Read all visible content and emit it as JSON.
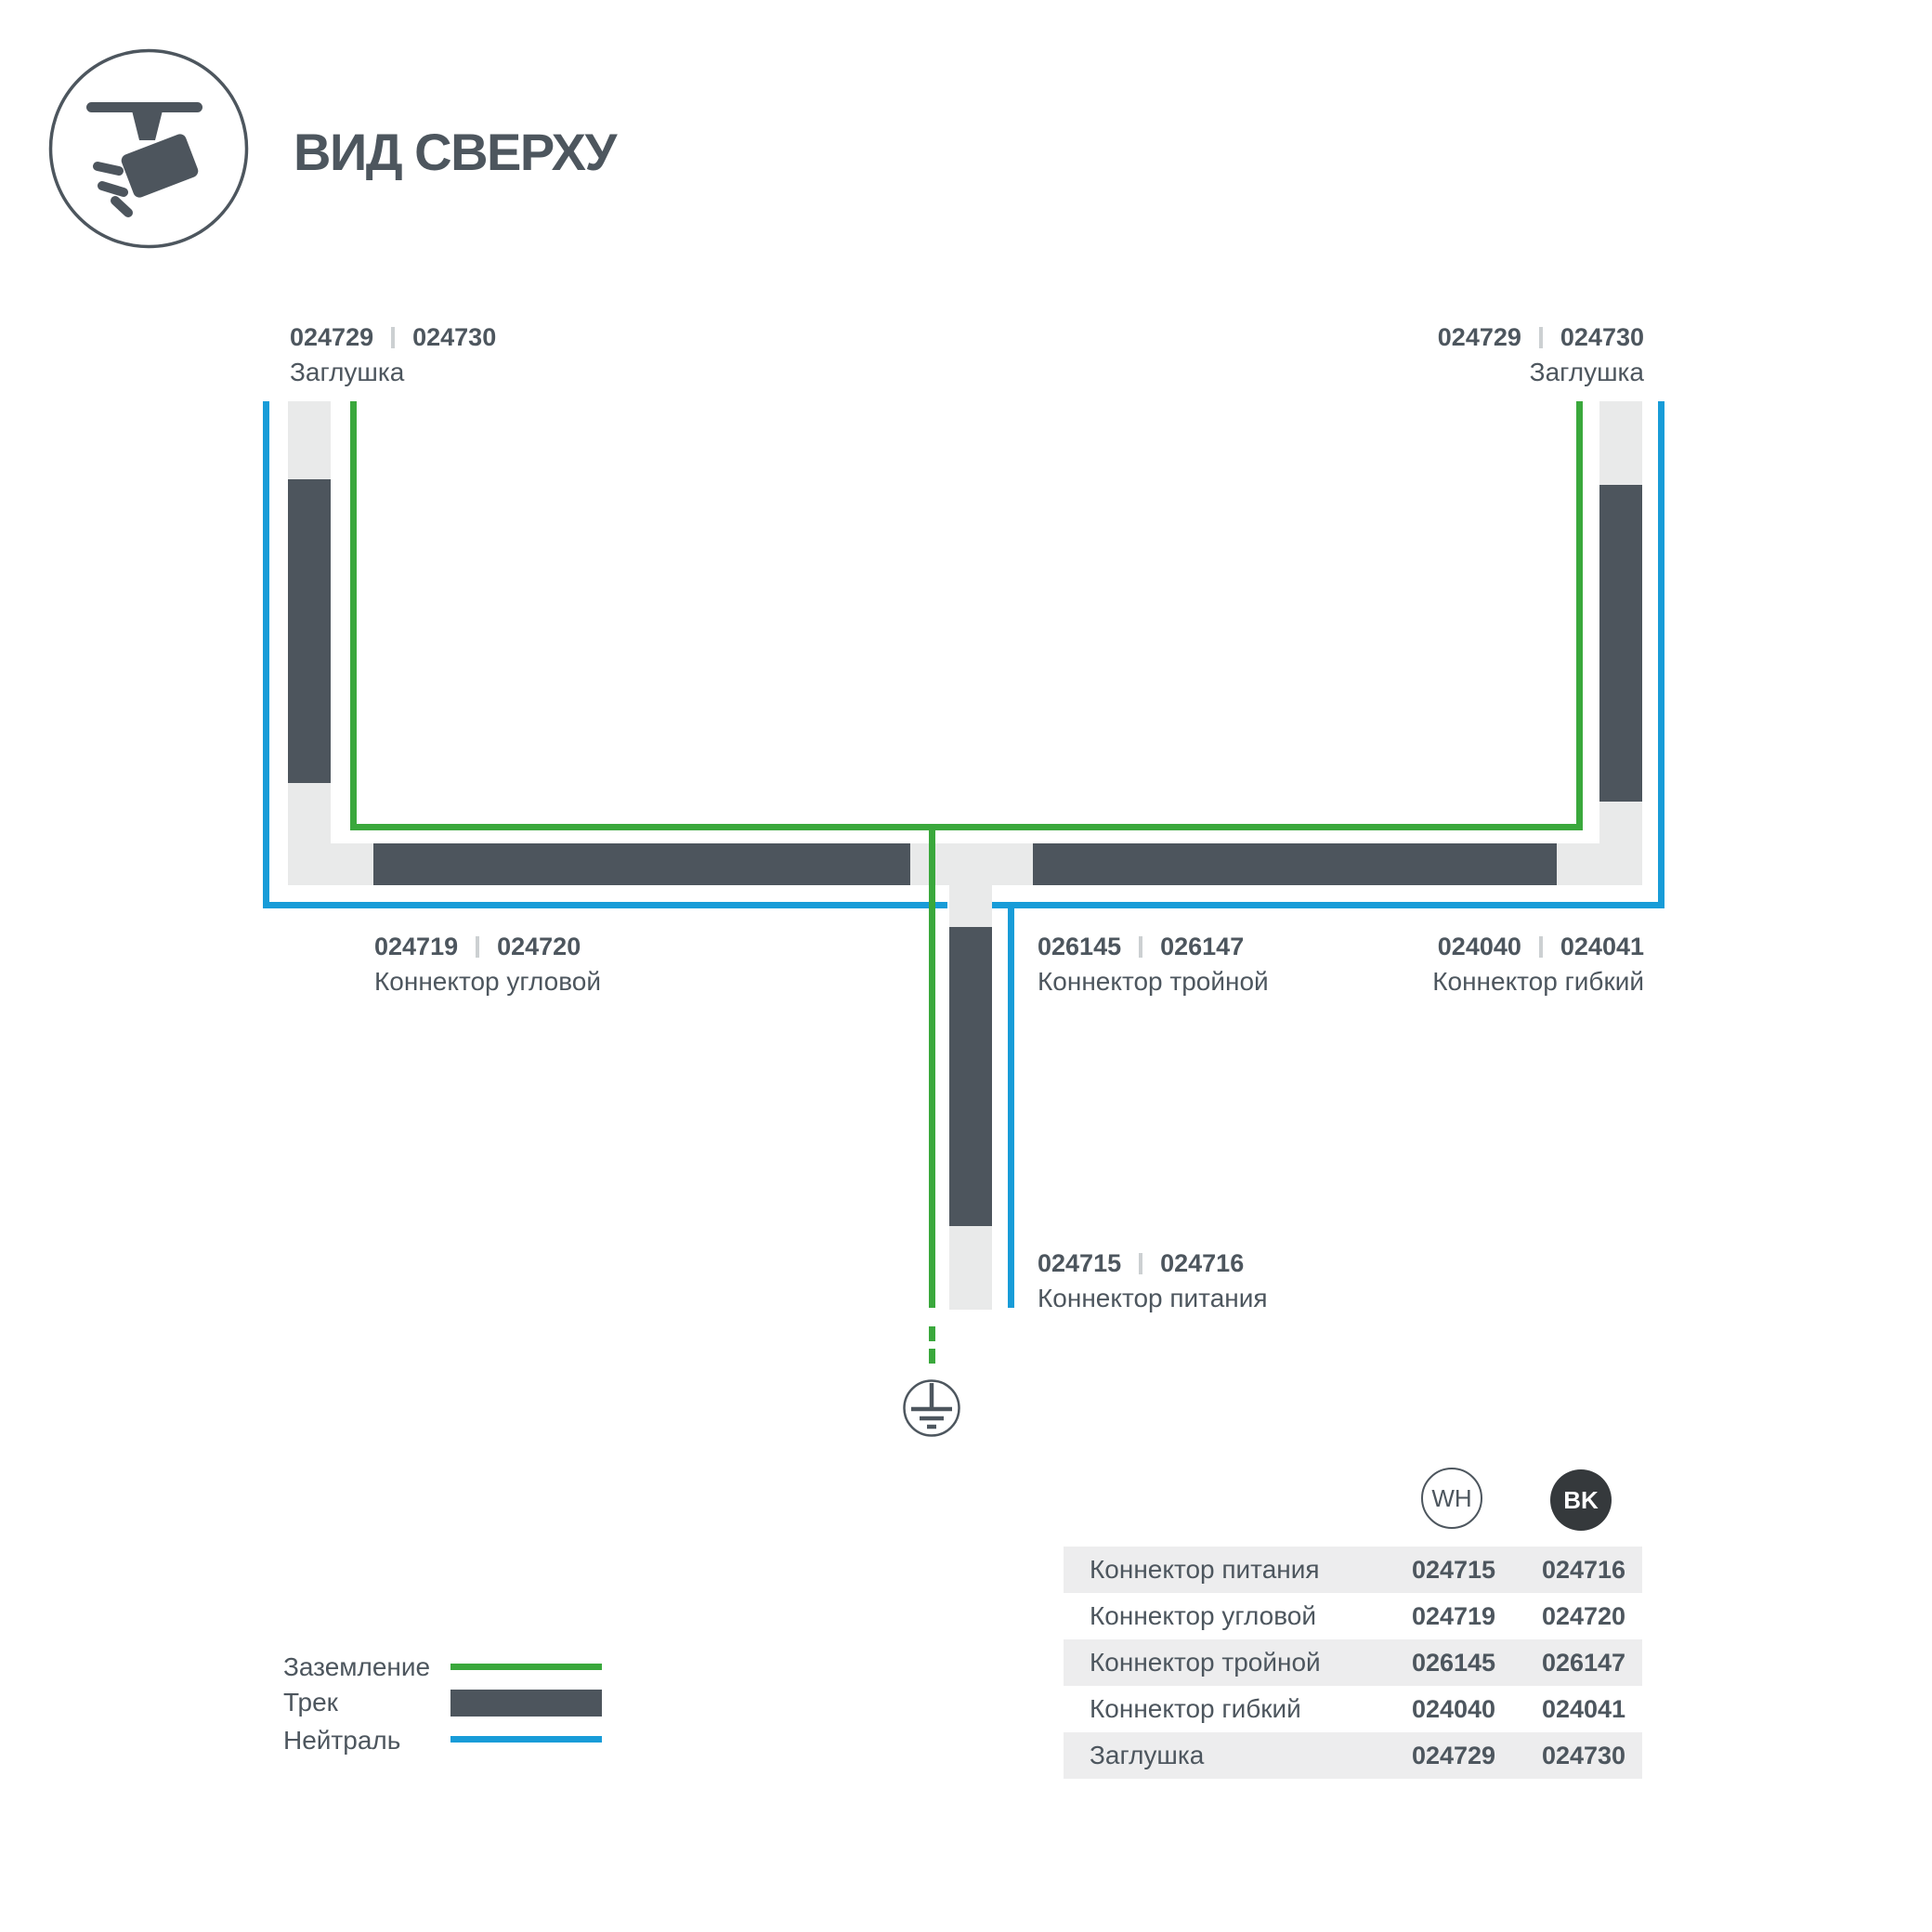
{
  "header": {
    "title": "ВИД СВЕРХУ"
  },
  "icons": {
    "header": "track-spotlight-top-view-icon",
    "ground": "earth-ground-icon"
  },
  "colors": {
    "ground": "#3aa83c",
    "neutral": "#189cd8",
    "track": "#4d555d",
    "connector": "#e9eaea",
    "rowalt": "#ededee",
    "text": "#4d565e",
    "bk": "#35393c",
    "divider": "#ccd0d2"
  },
  "diagram": {
    "labels": {
      "cap_left": {
        "code_wh": "024729",
        "code_bk": "024730",
        "name": "Заглушка"
      },
      "cap_right": {
        "code_wh": "024729",
        "code_bk": "024730",
        "name": "Заглушка"
      },
      "corner": {
        "code_wh": "024719",
        "code_bk": "024720",
        "name": "Коннектор угловой"
      },
      "triple": {
        "code_wh": "026145",
        "code_bk": "026147",
        "name": "Коннектор тройной"
      },
      "flex": {
        "code_wh": "024040",
        "code_bk": "024041",
        "name": "Коннектор гибкий"
      },
      "power": {
        "code_wh": "024715",
        "code_bk": "024716",
        "name": "Коннектор питания"
      }
    }
  },
  "legend": {
    "items": [
      {
        "label": "Заземление",
        "swatch": "ground-line"
      },
      {
        "label": "Трек",
        "swatch": "track-bar"
      },
      {
        "label": "Нейтраль",
        "swatch": "neutral-line"
      }
    ]
  },
  "table": {
    "columns": [
      {
        "label": "WH"
      },
      {
        "label": "BK"
      }
    ],
    "rows": [
      {
        "name": "Коннектор питания",
        "wh": "024715",
        "bk": "024716"
      },
      {
        "name": "Коннектор угловой",
        "wh": "024719",
        "bk": "024720"
      },
      {
        "name": "Коннектор тройной",
        "wh": "026145",
        "bk": "026147"
      },
      {
        "name": "Коннектор гибкий",
        "wh": "024040",
        "bk": "024041"
      },
      {
        "name": "Заглушка",
        "wh": "024729",
        "bk": "024730"
      }
    ]
  }
}
